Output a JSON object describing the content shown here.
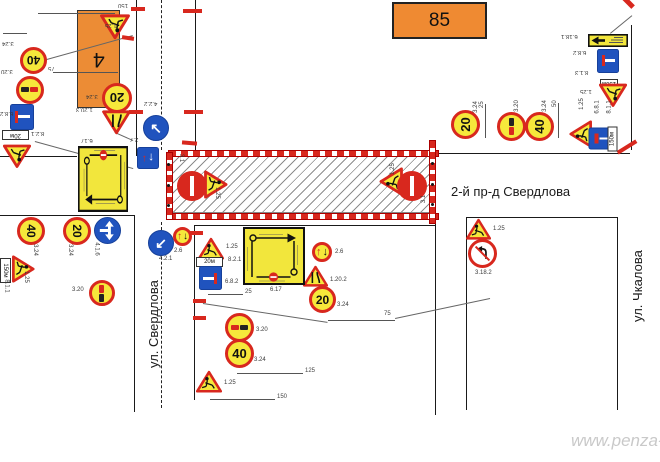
{
  "labels": {
    "building_number": "4",
    "object_number": "85",
    "street_horizontal": "2-й пр-д Свердлова",
    "street_left": "ул. Свердлова",
    "street_right": "ул. Чкалова",
    "watermark": "www.penza-"
  },
  "colors": {
    "sign_red": "#d8281e",
    "sign_yellow": "#f6e83b",
    "sign_blue": "#2053be",
    "building_orange": "#ec8c35",
    "line_black": "#1a1a1a",
    "watermark_gray": "#c9c9c9"
  },
  "work_zone": {
    "x": 170,
    "y": 155,
    "w": 263,
    "h": 58
  },
  "barriers": [
    {
      "kind": "h",
      "x": 168,
      "y": 150,
      "w": 269
    },
    {
      "kind": "h",
      "x": 168,
      "y": 213,
      "w": 269
    },
    {
      "kind": "v",
      "x": 166,
      "y": 152,
      "h": 66
    },
    {
      "kind": "v",
      "x": 429,
      "y": 140,
      "h": 82
    }
  ],
  "signs": [
    {
      "type": "speed",
      "value": "40",
      "x": 20,
      "y": 47,
      "s": 27,
      "rot": 180,
      "label": "3.24",
      "lx": 2,
      "ly": 40,
      "lrot": 180
    },
    {
      "type": "no-overtake",
      "x": 16,
      "y": 76,
      "s": 28,
      "rot": 180,
      "label": "3.20",
      "lx": 1,
      "ly": 68,
      "lrot": 180
    },
    {
      "type": "dead-end",
      "variant": "right",
      "x": 10,
      "y": 104,
      "w": 24,
      "h": 26,
      "rot": 180,
      "label": "6.8.2",
      "lx": 0,
      "ly": 110,
      "lrot": 180
    },
    {
      "type": "plate",
      "value": "20м",
      "x": 2,
      "y": 130,
      "w": 27,
      "h": 10,
      "rot": 180,
      "label": "8.2.1",
      "lx": 31,
      "ly": 130,
      "lrot": 180
    },
    {
      "type": "works",
      "x": 3,
      "y": 144,
      "s": 28,
      "rot": 180,
      "label": "",
      "lx": 0,
      "ly": 0,
      "lrot": 0
    },
    {
      "type": "works",
      "x": 100,
      "y": 14,
      "s": 30,
      "rot": 180,
      "label": "1.25",
      "lx": 105,
      "ly": 22,
      "lrot": 180
    },
    {
      "type": "speed",
      "value": "20",
      "x": 102,
      "y": 83,
      "s": 30,
      "rot": 180,
      "label": "3.24",
      "lx": 86,
      "ly": 93,
      "lrot": 180
    },
    {
      "type": "narrow",
      "variant": "left",
      "x": 102,
      "y": 110,
      "s": 29,
      "rot": 180,
      "label": "1.20.3",
      "lx": 76,
      "ly": 106,
      "lrot": 180
    },
    {
      "type": "avoid",
      "arrow": "↖",
      "x": 143,
      "y": 115,
      "s": 26,
      "rot": 0,
      "label": "4.2.2",
      "lx": 144,
      "ly": 100,
      "lrot": 180
    },
    {
      "type": "priority",
      "x": 137,
      "y": 147,
      "s": 22,
      "rot": 180,
      "label": "2.7",
      "lx": 130,
      "ly": 136,
      "lrot": 180
    },
    {
      "type": "avoid",
      "arrow": "↙",
      "x": 148,
      "y": 230,
      "s": 26,
      "rot": 0,
      "label": "4.2.1",
      "lx": 159,
      "ly": 256,
      "lrot": 0
    },
    {
      "type": "give-way",
      "x": 173,
      "y": 227,
      "s": 19,
      "rot": 0,
      "label": "2.6",
      "lx": 174,
      "ly": 248,
      "lrot": 0
    },
    {
      "type": "no-entry",
      "x": 177,
      "y": 171,
      "s": 30,
      "rot": 90,
      "label": "3.1",
      "lx": 177,
      "ly": 155,
      "lrot": 90
    },
    {
      "type": "works",
      "x": 202,
      "y": 172,
      "s": 28,
      "rot": 90,
      "label": "1.25",
      "lx": 211,
      "ly": 190,
      "lrot": 90
    },
    {
      "type": "works",
      "x": 377,
      "y": 169,
      "s": 28,
      "rot": -90,
      "label": "1.25",
      "lx": 387,
      "ly": 166,
      "lrot": -90
    },
    {
      "type": "no-entry",
      "x": 397,
      "y": 171,
      "s": 30,
      "rot": -90,
      "label": "3.1",
      "lx": 420,
      "ly": 196,
      "lrot": -90
    },
    {
      "type": "speed",
      "value": "20",
      "x": 451,
      "y": 110,
      "s": 29,
      "rot": -90,
      "label": "3.24",
      "lx": 470,
      "ly": 104,
      "lrot": -90
    },
    {
      "type": "no-overtake",
      "x": 497,
      "y": 112,
      "s": 29,
      "rot": -90,
      "label": "3.20",
      "lx": 511,
      "ly": 103,
      "lrot": -90
    },
    {
      "type": "speed",
      "value": "40",
      "x": 525,
      "y": 112,
      "s": 29,
      "rot": -90,
      "label": "3.24",
      "lx": 539,
      "ly": 103,
      "lrot": -90
    },
    {
      "type": "works",
      "x": 567,
      "y": 122,
      "s": 27,
      "rot": -90,
      "label": "1.25",
      "lx": 576,
      "ly": 101,
      "lrot": -90
    },
    {
      "type": "dead-end",
      "variant": "top",
      "x": 591,
      "y": 125,
      "w": 22,
      "h": 27,
      "rot": -90,
      "label": "6.8.1",
      "lx": 591,
      "ly": 104,
      "lrot": -90
    },
    {
      "type": "plate",
      "value": "150м",
      "x": 600,
      "y": 134,
      "w": 25,
      "h": 10,
      "rot": -90,
      "label": "8.1.1",
      "lx": 603,
      "ly": 104,
      "lrot": -90
    },
    {
      "type": "detour-rect",
      "x": 588,
      "y": 34,
      "w": 40,
      "h": 13,
      "rot": 180,
      "label": "6.18.1",
      "lx": 561,
      "ly": 33,
      "lrot": 180
    },
    {
      "type": "dead-end",
      "variant": "right",
      "x": 597,
      "y": 49,
      "w": 22,
      "h": 24,
      "rot": 180,
      "label": "6.8.2",
      "lx": 573,
      "ly": 49,
      "lrot": 180
    },
    {
      "type": "plate",
      "value": "150м",
      "x": 600,
      "y": 79,
      "w": 18,
      "h": 8,
      "rot": 180,
      "label": "8.1.3",
      "lx": 575,
      "ly": 69,
      "lrot": 180
    },
    {
      "type": "works",
      "x": 599,
      "y": 83,
      "s": 28,
      "rot": 180,
      "label": "1.25",
      "lx": 580,
      "ly": 88,
      "lrot": 180
    },
    {
      "type": "speed",
      "value": "40",
      "x": 17,
      "y": 217,
      "s": 28,
      "rot": 90,
      "label": "3.24",
      "lx": 29,
      "ly": 247,
      "lrot": 90
    },
    {
      "type": "speed",
      "value": "20",
      "x": 63,
      "y": 217,
      "s": 28,
      "rot": 90,
      "label": "3.24",
      "lx": 64,
      "ly": 247,
      "lrot": 90
    },
    {
      "type": "turns",
      "x": 94,
      "y": 217,
      "s": 27,
      "rot": 90,
      "label": "4.1.6",
      "lx": 90,
      "ly": 246,
      "lrot": 90
    },
    {
      "type": "works",
      "x": 10,
      "y": 257,
      "s": 27,
      "rot": 90,
      "label": "1.25",
      "lx": 20,
      "ly": 274,
      "lrot": 90
    },
    {
      "type": "plate",
      "value": "150м",
      "x": -7,
      "y": 265,
      "w": 25,
      "h": 11,
      "rot": 90,
      "label": "8.1.1",
      "lx": 0,
      "ly": 283,
      "lrot": 90
    },
    {
      "type": "no-overtake",
      "x": 89,
      "y": 280,
      "s": 26,
      "rot": 90,
      "label": "3.20",
      "lx": 72,
      "ly": 287,
      "lrot": 0
    },
    {
      "type": "works",
      "x": 198,
      "y": 237,
      "s": 26,
      "rot": 0,
      "label": "1.25",
      "lx": 226,
      "ly": 244,
      "lrot": 0
    },
    {
      "type": "plate",
      "value": "20м",
      "x": 196,
      "y": 257,
      "w": 27,
      "h": 10,
      "rot": 0,
      "label": "8.2.1",
      "lx": 228,
      "ly": 257,
      "lrot": 0
    },
    {
      "type": "dead-end",
      "variant": "right",
      "x": 199,
      "y": 266,
      "w": 23,
      "h": 24,
      "rot": 0,
      "label": "6.8.2",
      "lx": 225,
      "ly": 279,
      "lrot": 0
    },
    {
      "type": "no-overtake",
      "x": 225,
      "y": 313,
      "s": 29,
      "rot": 0,
      "label": "3.20",
      "lx": 256,
      "ly": 327,
      "lrot": 0
    },
    {
      "type": "speed",
      "value": "40",
      "x": 225,
      "y": 339,
      "s": 29,
      "rot": 0,
      "label": "3.24",
      "lx": 254,
      "ly": 357,
      "lrot": 0
    },
    {
      "type": "works",
      "x": 196,
      "y": 370,
      "s": 26,
      "rot": 0,
      "label": "1.25",
      "lx": 224,
      "ly": 380,
      "lrot": 0
    },
    {
      "type": "give-way",
      "x": 312,
      "y": 242,
      "s": 20,
      "rot": 0,
      "label": "2.6",
      "lx": 335,
      "ly": 249,
      "lrot": 0
    },
    {
      "type": "narrow",
      "variant": "right",
      "x": 303,
      "y": 265,
      "s": 25,
      "rot": 0,
      "label": "1.20.2",
      "lx": 330,
      "ly": 277,
      "lrot": 0
    },
    {
      "type": "speed",
      "value": "20",
      "x": 309,
      "y": 286,
      "s": 27,
      "rot": 0,
      "label": "3.24",
      "lx": 337,
      "ly": 302,
      "lrot": 0
    },
    {
      "type": "detour-scheme",
      "x": 243,
      "y": 227,
      "w": 62,
      "h": 58,
      "rot": 0,
      "label": "6.17",
      "lx": 270,
      "ly": 287,
      "lrot": 0
    },
    {
      "type": "detour-scheme",
      "x": 78,
      "y": 146,
      "w": 50,
      "h": 66,
      "rot": 180,
      "label": "6.17",
      "lx": 81,
      "ly": 137,
      "lrot": 180
    },
    {
      "type": "works",
      "x": 466,
      "y": 218,
      "s": 25,
      "rot": 0,
      "label": "1.25",
      "lx": 493,
      "ly": 226,
      "lrot": 0
    },
    {
      "type": "no-left-turn",
      "x": 468,
      "y": 239,
      "s": 29,
      "rot": 0,
      "label": "3.18.2",
      "lx": 475,
      "ly": 270,
      "lrot": 0
    }
  ],
  "lines": [
    {
      "x1": 137,
      "y1": 0,
      "x2": 137,
      "y2": 156,
      "k": "solid"
    },
    {
      "x1": 196,
      "y1": 0,
      "x2": 196,
      "y2": 152,
      "k": "solid"
    },
    {
      "x1": 162,
      "y1": 0,
      "x2": 162,
      "y2": 150,
      "k": "dash"
    },
    {
      "x1": 162,
      "y1": 222,
      "x2": 162,
      "y2": 408,
      "k": "dash"
    },
    {
      "x1": 0,
      "y1": 215,
      "x2": 135,
      "y2": 215,
      "k": "solid"
    },
    {
      "x1": 135,
      "y1": 215,
      "x2": 135,
      "y2": 412,
      "k": "solid"
    },
    {
      "x1": 0,
      "y1": 156,
      "x2": 77,
      "y2": 156,
      "k": "solid"
    },
    {
      "x1": 195,
      "y1": 225,
      "x2": 195,
      "y2": 400,
      "k": "solid"
    },
    {
      "x1": 195,
      "y1": 225,
      "x2": 436,
      "y2": 225,
      "k": "solid"
    },
    {
      "x1": 436,
      "y1": 160,
      "x2": 436,
      "y2": 415,
      "k": "solid"
    },
    {
      "x1": 467,
      "y1": 217,
      "x2": 618,
      "y2": 217,
      "k": "solid"
    },
    {
      "x1": 467,
      "y1": 217,
      "x2": 467,
      "y2": 410,
      "k": "solid"
    },
    {
      "x1": 618,
      "y1": 217,
      "x2": 618,
      "y2": 410,
      "k": "solid"
    },
    {
      "x1": 433,
      "y1": 153,
      "x2": 630,
      "y2": 153,
      "k": "solid"
    },
    {
      "x1": 632,
      "y1": 25,
      "x2": 632,
      "y2": 150,
      "k": "solid"
    },
    {
      "x1": 38,
      "y1": 13,
      "x2": 115,
      "y2": 13,
      "k": "dim"
    },
    {
      "x1": 53,
      "y1": 72,
      "x2": 118,
      "y2": 72,
      "k": "dim"
    },
    {
      "x1": 3,
      "y1": 33,
      "x2": 27,
      "y2": 33,
      "k": "dim"
    },
    {
      "x1": 208,
      "y1": 294,
      "x2": 243,
      "y2": 294,
      "k": "dim"
    },
    {
      "x1": 328,
      "y1": 320,
      "x2": 395,
      "y2": 320,
      "k": "dim"
    },
    {
      "x1": 237,
      "y1": 373,
      "x2": 303,
      "y2": 373,
      "k": "dim"
    },
    {
      "x1": 210,
      "y1": 399,
      "x2": 275,
      "y2": 399,
      "k": "dim"
    },
    {
      "x1": 486,
      "y1": 104,
      "x2": 486,
      "y2": 138,
      "k": "dim"
    },
    {
      "x1": 559,
      "y1": 103,
      "x2": 559,
      "y2": 138,
      "k": "dim"
    },
    {
      "x1": 43,
      "y1": 60,
      "x2": 133,
      "y2": 35,
      "k": "leader"
    },
    {
      "x1": 35,
      "y1": 141,
      "x2": 133,
      "y2": 168,
      "k": "leader"
    },
    {
      "x1": 115,
      "y1": 132,
      "x2": 133,
      "y2": 140,
      "k": "leader"
    },
    {
      "x1": 203,
      "y1": 303,
      "x2": 328,
      "y2": 322,
      "k": "leader"
    },
    {
      "x1": 395,
      "y1": 318,
      "x2": 490,
      "y2": 298,
      "k": "leader"
    },
    {
      "x1": 610,
      "y1": 33,
      "x2": 632,
      "y2": 15,
      "k": "leader"
    }
  ],
  "ticks": [
    {
      "x": 131,
      "y": 7,
      "w": 14,
      "h": 4,
      "rot": 0
    },
    {
      "x": 183,
      "y": 9,
      "w": 19,
      "h": 4,
      "rot": 0
    },
    {
      "x": 122,
      "y": 36,
      "w": 12,
      "h": 4,
      "rot": 8
    },
    {
      "x": 129,
      "y": 110,
      "w": 14,
      "h": 4,
      "rot": 0
    },
    {
      "x": 184,
      "y": 110,
      "w": 19,
      "h": 4,
      "rot": 0
    },
    {
      "x": 182,
      "y": 141,
      "w": 15,
      "h": 4,
      "rot": 5
    },
    {
      "x": 186,
      "y": 231,
      "w": 17,
      "h": 4,
      "rot": 0
    },
    {
      "x": 193,
      "y": 299,
      "w": 13,
      "h": 4,
      "rot": 0
    },
    {
      "x": 193,
      "y": 316,
      "w": 13,
      "h": 4,
      "rot": 0
    },
    {
      "x": 622,
      "y": 0,
      "w": 13,
      "h": 5,
      "rot": 45
    },
    {
      "x": 616,
      "y": 145,
      "w": 22,
      "h": 4,
      "rot": -32
    }
  ],
  "dots": [
    {
      "x": 167,
      "y": 163
    },
    {
      "x": 167,
      "y": 184
    },
    {
      "x": 167,
      "y": 204
    },
    {
      "x": 431,
      "y": 162
    },
    {
      "x": 431,
      "y": 183
    },
    {
      "x": 431,
      "y": 203
    }
  ],
  "texts": [
    {
      "t": "150",
      "x": 118,
      "y": 2,
      "rot": 180,
      "size": 6,
      "cls": "dim"
    },
    {
      "t": "75",
      "x": 48,
      "y": 65,
      "rot": 180,
      "size": 6,
      "cls": "dim"
    },
    {
      "t": "25",
      "x": 245,
      "y": 289,
      "rot": 0,
      "size": 6,
      "cls": "dim"
    },
    {
      "t": "75",
      "x": 384,
      "y": 311,
      "rot": 0,
      "size": 6,
      "cls": "dim"
    },
    {
      "t": "125",
      "x": 305,
      "y": 368,
      "rot": 0,
      "size": 6,
      "cls": "dim"
    },
    {
      "t": "150",
      "x": 277,
      "y": 394,
      "rot": 0,
      "size": 6,
      "cls": "dim"
    },
    {
      "t": "25",
      "x": 479,
      "y": 108,
      "rot": -90,
      "size": 6,
      "cls": "dim"
    },
    {
      "t": "50",
      "x": 552,
      "y": 107,
      "rot": -90,
      "size": 6,
      "cls": "dim"
    }
  ]
}
